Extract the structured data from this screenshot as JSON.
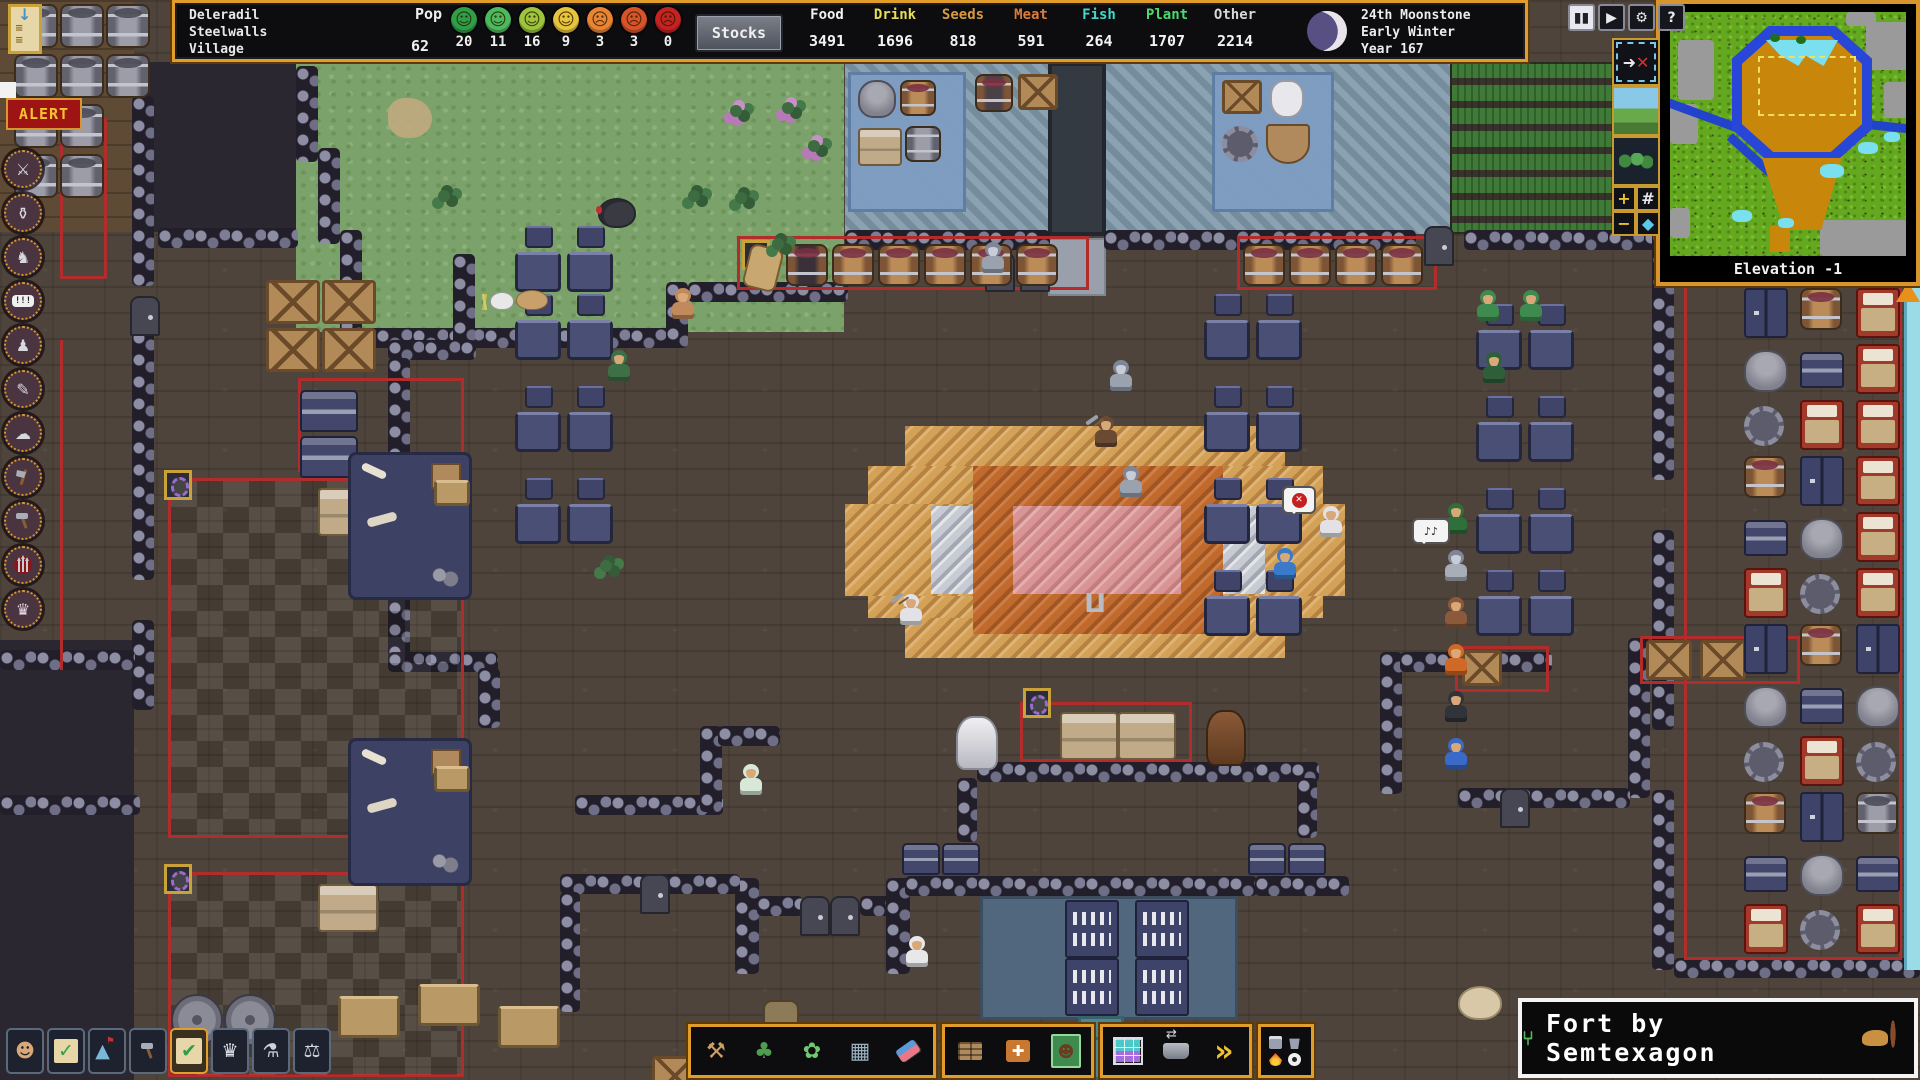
{
  "top_bar": {
    "fort_name_lines": "Deleradil\nSteelwalls\nVillage",
    "pop": {
      "label": "Pop",
      "total": "62",
      "moods": [
        {
          "name": "ecstatic",
          "color": "#2f9e48",
          "count": "20"
        },
        {
          "name": "happy",
          "color": "#4cba5c",
          "count": "11"
        },
        {
          "name": "content",
          "color": "#9cc43c",
          "count": "16"
        },
        {
          "name": "fine",
          "color": "#e8c43c",
          "count": "9"
        },
        {
          "name": "unhappy",
          "color": "#e88434",
          "count": "3"
        },
        {
          "name": "angry",
          "color": "#d85428",
          "count": "3"
        },
        {
          "name": "furious",
          "color": "#c62222",
          "count": "0"
        }
      ]
    },
    "stocks_button": "Stocks",
    "resources": [
      {
        "label": "Food",
        "value": "3491",
        "color": "#f2f2f2"
      },
      {
        "label": "Drink",
        "value": "1696",
        "color": "#e8df58"
      },
      {
        "label": "Seeds",
        "value": "818",
        "color": "#d99a3e"
      },
      {
        "label": "Meat",
        "value": "591",
        "color": "#e07a3a"
      },
      {
        "label": "Fish",
        "value": "264",
        "color": "#45d8c8"
      },
      {
        "label": "Plant",
        "value": "1707",
        "color": "#4cd96c"
      },
      {
        "label": "Other",
        "value": "2214",
        "color": "#d8d8d8"
      }
    ],
    "date_lines": "24th Moonstone\nEarly Winter\nYear 167"
  },
  "window_controls": [
    {
      "name": "pause-button",
      "glyph": "▮▮",
      "lit": true
    },
    {
      "name": "play-button",
      "glyph": "▶",
      "lit": false
    },
    {
      "name": "settings-button",
      "glyph": "⚙",
      "lit": false
    },
    {
      "name": "help-button",
      "glyph": "?",
      "lit": false
    }
  ],
  "view_strip": [
    {
      "name": "follow-cancel-button",
      "glyph": "➜✕"
    },
    {
      "name": "surface-view-button",
      "glyph": ""
    },
    {
      "name": "cavern-view-button",
      "glyph": ""
    },
    {
      "name": "zoom-in-button",
      "glyph": "+"
    },
    {
      "name": "grid-toggle-button",
      "glyph": "#"
    },
    {
      "name": "zoom-out-button",
      "glyph": "−"
    },
    {
      "name": "depth-water-button",
      "glyph": "◆"
    }
  ],
  "minimap": {
    "elevation_label": "Elevation -1"
  },
  "alert_label": "ALERT",
  "watermark_text": "Fort by Semtexagon",
  "left_sidebar": {
    "items": [
      {
        "name": "military-icon",
        "glyph": "⚔"
      },
      {
        "name": "tavern-icon",
        "glyph": "⚱"
      },
      {
        "name": "creatures-icon",
        "glyph": "♞"
      },
      {
        "name": "reports-icon",
        "glyph": "!!!"
      },
      {
        "name": "statues-icon",
        "glyph": "♟"
      },
      {
        "name": "records-icon",
        "glyph": "✎"
      },
      {
        "name": "weather-icon",
        "glyph": "☁"
      },
      {
        "name": "woodcutting-icon",
        "glyph": "axe"
      },
      {
        "name": "building-icon",
        "glyph": "hammer"
      },
      {
        "name": "threats-icon",
        "glyph": "spears"
      },
      {
        "name": "nobles-icon",
        "glyph": "♛"
      }
    ]
  },
  "bottom_left_toolbar": [
    {
      "name": "citizens-button",
      "glyph": "☻"
    },
    {
      "name": "tasks-button",
      "glyph": "✓"
    },
    {
      "name": "places-button",
      "glyph": "▲"
    },
    {
      "name": "labor-button",
      "glyph": "hammer"
    },
    {
      "name": "work-orders-button",
      "glyph": "✔",
      "highlight": true
    },
    {
      "name": "nobles-button",
      "glyph": "♛"
    },
    {
      "name": "objects-button",
      "glyph": "⚗"
    },
    {
      "name": "justice-button",
      "glyph": "⚖"
    }
  ],
  "center_toolbar": {
    "designations": [
      {
        "name": "dig-button",
        "glyph": "⚒"
      },
      {
        "name": "chop-button",
        "glyph": "♣"
      },
      {
        "name": "gather-button",
        "glyph": "✿"
      },
      {
        "name": "smooth-button",
        "glyph": "▦"
      },
      {
        "name": "erase-button",
        "glyph": "eraser"
      }
    ],
    "construction": [
      {
        "name": "build-button",
        "glyph": "brick"
      },
      {
        "name": "workshop-button",
        "glyph": "plusbox"
      },
      {
        "name": "burrows-button",
        "glyph": "burrow"
      }
    ],
    "logistics": [
      {
        "name": "stockpiles-button",
        "glyph": "stock"
      },
      {
        "name": "hauling-button",
        "glyph": "cart"
      },
      {
        "name": "more-button",
        "glyph": "»"
      }
    ],
    "commands_button": {
      "name": "item-commands-button",
      "minis": [
        "chesty",
        "trash",
        "flame",
        "eye"
      ]
    }
  }
}
